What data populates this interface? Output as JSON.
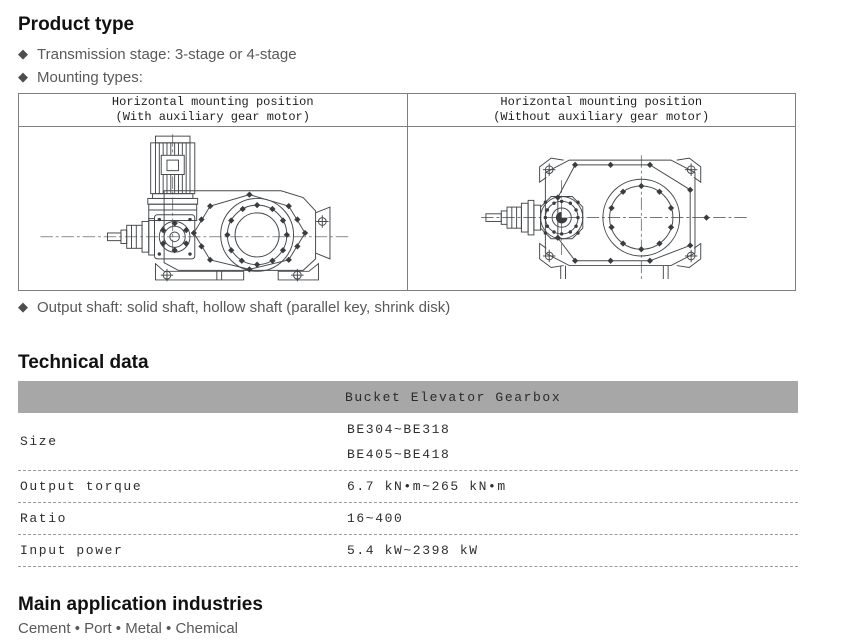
{
  "product_type": {
    "heading": "Product type",
    "bullets": [
      {
        "text": "Transmission stage: 3-stage or 4-stage"
      },
      {
        "text": "Mounting types:"
      }
    ],
    "output_shaft_bullet": "Output shaft: solid shaft, hollow shaft (parallel key, shrink disk)"
  },
  "mounting_table": {
    "columns": [
      {
        "title_line1": "Horizontal mounting position",
        "title_line2": "(With auxiliary gear motor)",
        "drawing": "gearbox-with-auxiliary-gear-motor"
      },
      {
        "title_line1": "Horizontal mounting position",
        "title_line2": "(Without auxiliary gear motor)",
        "drawing": "gearbox-without-auxiliary-gear-motor"
      }
    ]
  },
  "technical_data": {
    "heading": "Technical data",
    "column_header": "Bucket Elevator Gearbox",
    "rows": [
      {
        "label": "Size",
        "values": [
          "BE304~BE318",
          "BE405~BE418"
        ]
      },
      {
        "label": "Output torque",
        "values": [
          "6.7 kN•m~265 kN•m"
        ]
      },
      {
        "label": "Ratio",
        "values": [
          "16~400"
        ]
      },
      {
        "label": "Input power",
        "values": [
          "5.4 kW~2398 kW"
        ]
      }
    ]
  },
  "applications": {
    "heading": "Main application industries",
    "items": [
      "Cement",
      "Port",
      "Metal",
      "Chemical"
    ],
    "separator": "•"
  },
  "icons": {
    "bullet_icon": "diamond-icon"
  },
  "colors": {
    "heading_text": "#111111",
    "body_text": "#58595b",
    "bullet_diamond": "#4d4d4f",
    "table_border": "#7f7f7f",
    "tech_header_bg": "#a7a7a7",
    "tech_text": "#2e2e2e",
    "dashed_divider": "#9a9a9a",
    "drawing_stroke": "#45484b"
  }
}
